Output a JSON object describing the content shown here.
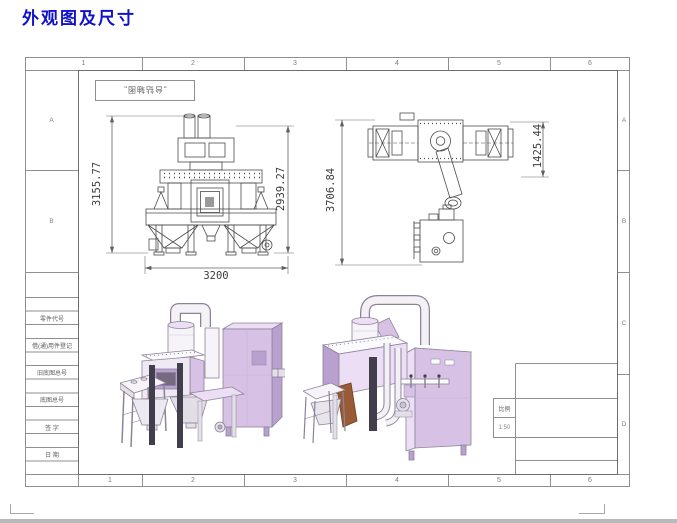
{
  "page": {
    "title": "外观图及尺寸"
  },
  "drawing": {
    "view_label": "„台钻轴图„",
    "grid": {
      "cols": [
        "1",
        "2",
        "3",
        "4",
        "5",
        "6"
      ],
      "rows": [
        "A",
        "B",
        "C",
        "D"
      ]
    },
    "front_view": {
      "dim_height_left": "3155.77",
      "dim_height_right": "2939.27",
      "dim_width": "3200"
    },
    "top_view": {
      "dim_length": "3706.84",
      "dim_width": "1425.44"
    },
    "parts_table": {
      "rows": [
        "零件代号",
        "借(通)用件登记",
        "旧底图总号",
        "底图总号",
        "签  字",
        "日  期"
      ]
    },
    "title_block": {
      "scale_label": "比例",
      "scale_value": "1:50"
    }
  }
}
